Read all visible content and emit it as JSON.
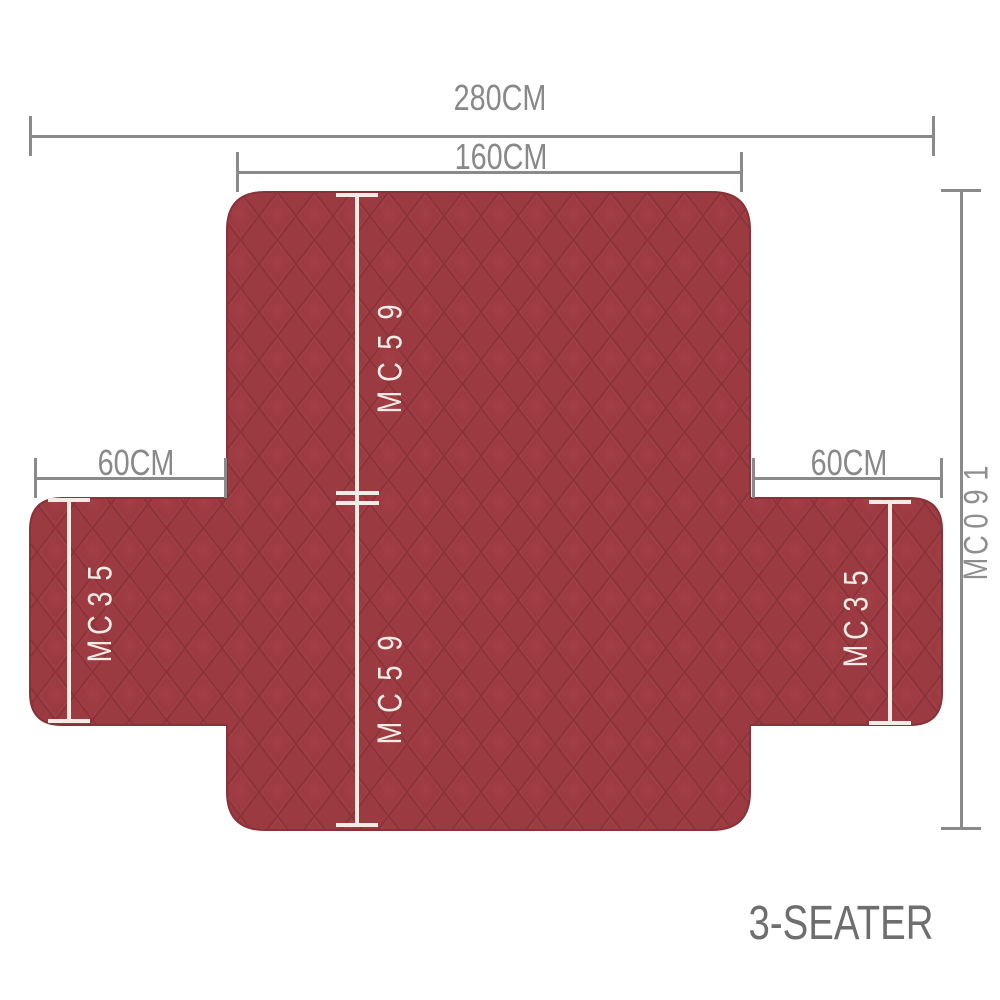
{
  "diagram": {
    "product": {
      "type_label": "3-SEATER"
    },
    "dims": {
      "total_width": "280CM",
      "seat_width": "160CM",
      "backrest_height": "95CM",
      "seat_depth": "95CM",
      "armrest_left_width": "60CM",
      "armrest_right_width": "60CM",
      "armrest_left_height": "53CM",
      "armrest_right_height": "53CM",
      "total_length": "190CM"
    },
    "colors": {
      "background": "#ffffff",
      "fabric": "#9c3a41",
      "fabric_quilt_dark": "#84303ri7",
      "fabric_quilt_light": "#aa464c",
      "dimension_line_gray": "#8a8a8a",
      "dimension_line_white": "#f3ece6",
      "product_label_gray": "#6e6e6e"
    }
  }
}
